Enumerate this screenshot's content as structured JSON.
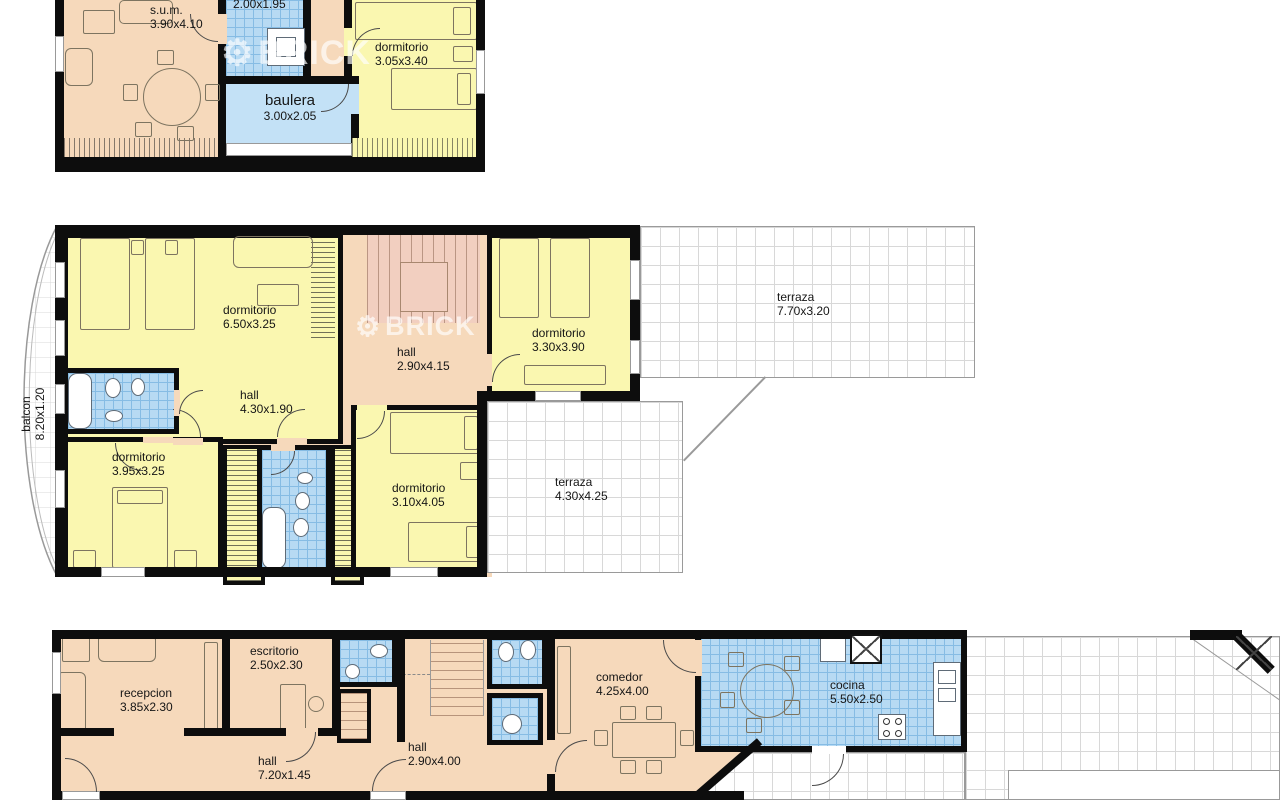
{
  "watermark": {
    "brand": "BRICK"
  },
  "palette": {
    "room_peach": "#f6d9bb",
    "room_yellow": "#faf7b0",
    "room_blue_tile": "#b7daf3",
    "room_blue_solid": "#c3e1f6",
    "wall_black": "#0d0d0d",
    "tile_line_blue": "#86bce4",
    "tile_line_gray": "#d8d8d8",
    "watermark_white": "rgba(255,255,255,0.66)"
  },
  "floors": {
    "upper": {
      "rooms": {
        "sum": {
          "label": "s.u.m.",
          "dims": "3.90x4.10"
        },
        "bath": {
          "label": "",
          "dims": "2.00x1.95"
        },
        "baulera": {
          "label": "baulera",
          "dims": "3.00x2.05"
        },
        "dormitorio": {
          "label": "dormitorio",
          "dims": "3.05x3.40"
        }
      }
    },
    "middle": {
      "rooms": {
        "dorm_big": {
          "label": "dormitorio",
          "dims": "6.50x3.25"
        },
        "stair_hall": {
          "label": "hall",
          "dims": "2.90x4.15"
        },
        "dorm_right": {
          "label": "dormitorio",
          "dims": "3.30x3.90"
        },
        "hall": {
          "label": "hall",
          "dims": "4.30x1.90"
        },
        "dorm_left": {
          "label": "dormitorio",
          "dims": "3.95x3.25"
        },
        "dorm_center": {
          "label": "dormitorio",
          "dims": "3.10x4.05"
        },
        "terraza_large": {
          "label": "terraza",
          "dims": "7.70x3.20"
        },
        "terraza_small": {
          "label": "terraza",
          "dims": "4.30x4.25"
        },
        "balcon": {
          "label": "balcon",
          "dims": "8.20x1.20"
        }
      }
    },
    "ground": {
      "rooms": {
        "recepcion": {
          "label": "recepcion",
          "dims": "3.85x2.30"
        },
        "escritorio": {
          "label": "escritorio",
          "dims": "2.50x2.30"
        },
        "hall_long": {
          "label": "hall",
          "dims": "7.20x1.45"
        },
        "hall_stairs": {
          "label": "hall",
          "dims": "2.90x4.00"
        },
        "comedor": {
          "label": "comedor",
          "dims": "4.25x4.00"
        },
        "cocina": {
          "label": "cocina",
          "dims": "5.50x2.50"
        }
      }
    }
  }
}
